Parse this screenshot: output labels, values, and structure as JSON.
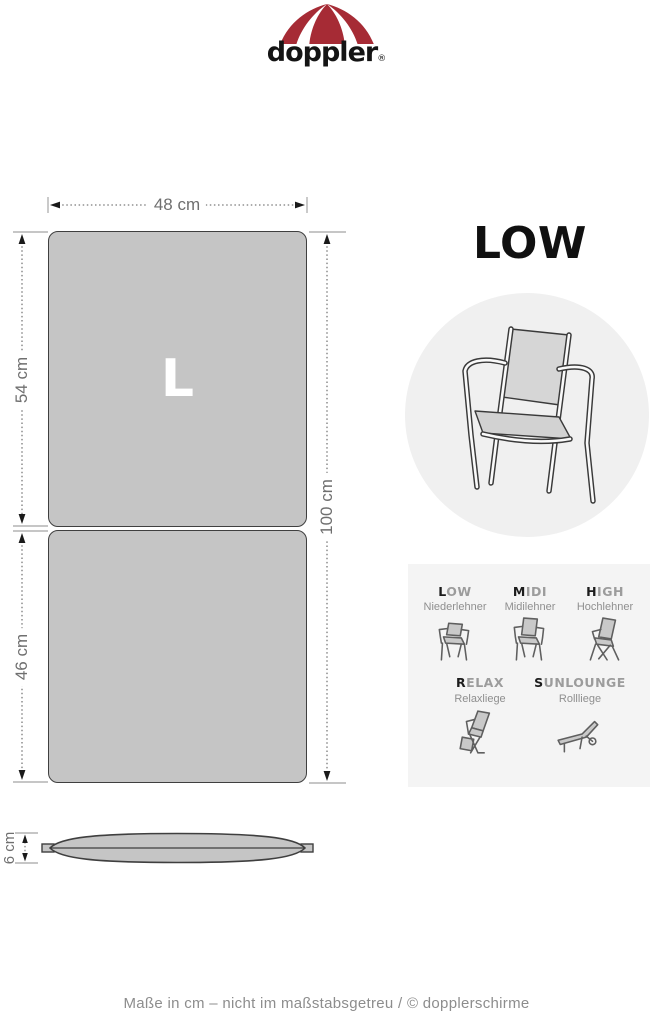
{
  "header": {
    "wordmark": "doppler",
    "registered": "®"
  },
  "colors": {
    "brand_red": "#a62b35",
    "cushion_gray": "#c5c5c5",
    "panel_gray": "#f4f4f4",
    "circle_gray": "#f0f0f0"
  },
  "diagram": {
    "size_letter": "L",
    "width_cm": 48,
    "upper_height_cm": 54,
    "lower_height_cm": 46,
    "total_height_cm": 100,
    "thickness_cm": 6,
    "width_label": "48 cm",
    "upper_label": "54 cm",
    "lower_label": "46 cm",
    "total_label": "100 cm",
    "thickness_label": "6 cm"
  },
  "product_type": {
    "title": "LOW"
  },
  "legend": {
    "items": [
      {
        "first": "L",
        "rest": "OW",
        "sub": "Niederlehner"
      },
      {
        "first": "M",
        "rest": "IDI",
        "sub": "Midilehner"
      },
      {
        "first": "H",
        "rest": "IGH",
        "sub": "Hochlehner"
      },
      {
        "first": "R",
        "rest": "ELAX",
        "sub": "Relaxliege"
      },
      {
        "first": "S",
        "rest": "UNLOUNGE",
        "sub": "Rollliege"
      }
    ]
  },
  "footer": {
    "note": "Maße in cm – nicht im maßstabsgetreu / © dopplerschirme"
  }
}
